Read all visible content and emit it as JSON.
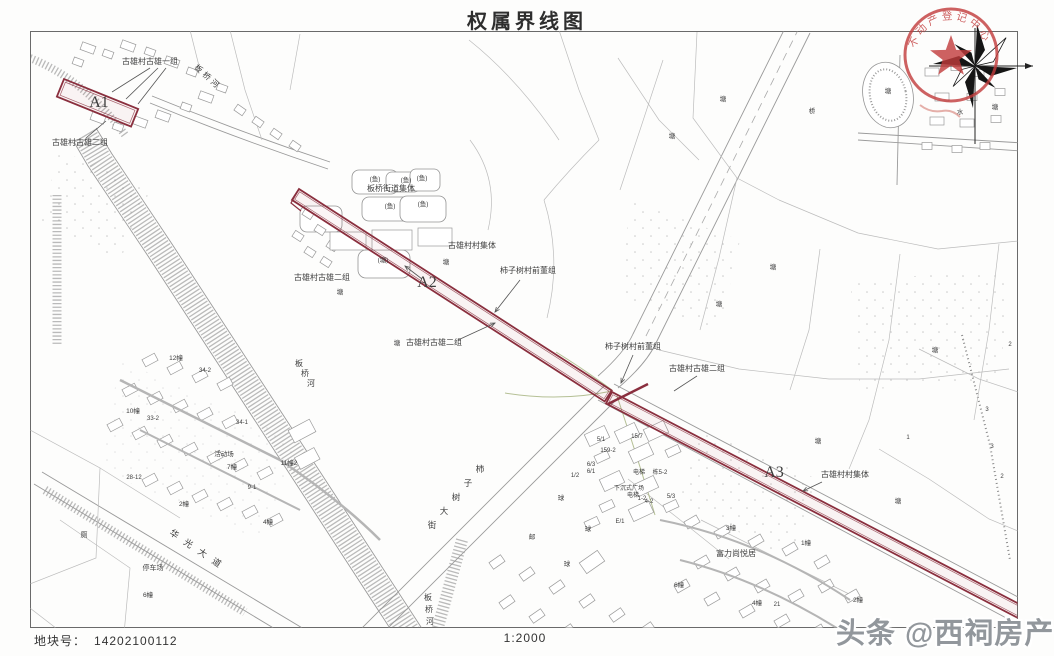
{
  "title": "权属界线图",
  "footer": {
    "plot_label": "地块号：",
    "plot_number": "14202100112",
    "scale": "1:2000"
  },
  "watermark": "头条 @西祠房产",
  "seal": {
    "arc_text": "不动产登记中心",
    "star": "★"
  },
  "parcels": {
    "a1": "A1",
    "a2": "A2",
    "a3": "A3"
  },
  "map_labels": [
    {
      "t": "古雄村古雄一组",
      "x": 150,
      "y": 64,
      "s": 8
    },
    {
      "t": "A1",
      "x": 99,
      "y": 107,
      "s": 16,
      "f": "serif"
    },
    {
      "t": "古雄村古雄二组",
      "x": 80,
      "y": 145,
      "s": 8
    },
    {
      "t": "板桥河",
      "x": 206,
      "y": 79,
      "s": 8,
      "rot": 42,
      "ls": 3
    },
    {
      "t": "板桥街道集体",
      "x": 391,
      "y": 191,
      "s": 8
    },
    {
      "t": "(鱼)",
      "x": 375,
      "y": 181,
      "s": 6.5
    },
    {
      "t": "(鱼)",
      "x": 406,
      "y": 182,
      "s": 6.5
    },
    {
      "t": "(鱼)",
      "x": 422,
      "y": 180,
      "s": 6.5
    },
    {
      "t": "(鱼)",
      "x": 390,
      "y": 208,
      "s": 6.5
    },
    {
      "t": "(鱼)",
      "x": 423,
      "y": 206,
      "s": 6.5
    },
    {
      "t": "(塘)",
      "x": 383,
      "y": 262,
      "s": 6.5
    },
    {
      "t": "塘",
      "x": 446,
      "y": 264,
      "s": 6.5
    },
    {
      "t": "古雄村村集体",
      "x": 472,
      "y": 248,
      "s": 8
    },
    {
      "t": "柿子树村前董组",
      "x": 528,
      "y": 273,
      "s": 8
    },
    {
      "t": "A2",
      "x": 427,
      "y": 287,
      "s": 16,
      "f": "serif"
    },
    {
      "t": "古雄村古雄二组",
      "x": 322,
      "y": 280,
      "s": 8
    },
    {
      "t": "塘",
      "x": 340,
      "y": 294,
      "s": 6.5
    },
    {
      "t": "塘",
      "x": 397,
      "y": 345,
      "s": 6.5
    },
    {
      "t": "古雄村古雄二组",
      "x": 434,
      "y": 345,
      "s": 8
    },
    {
      "t": "柿子树村前董组",
      "x": 633,
      "y": 349,
      "s": 8
    },
    {
      "t": "古雄村古雄二组",
      "x": 697,
      "y": 371,
      "s": 8
    },
    {
      "t": "A3",
      "x": 774,
      "y": 477,
      "s": 16,
      "f": "serif"
    },
    {
      "t": "古雄村村集体",
      "x": 845,
      "y": 477,
      "s": 8
    },
    {
      "t": "富力尚悦居",
      "x": 736,
      "y": 556,
      "s": 8
    },
    {
      "t": "华光大道",
      "x": 197,
      "y": 553,
      "s": 9,
      "rot": 34,
      "ls": 8
    },
    {
      "t": "停车场",
      "x": 153,
      "y": 570,
      "s": 7
    },
    {
      "t": "厕",
      "x": 84,
      "y": 537,
      "s": 7
    },
    {
      "t": "板桥河",
      "x": 428,
      "y": 600,
      "s": 8,
      "vert": true,
      "cdx": 1,
      "cdy": 12
    },
    {
      "t": "板桥河",
      "x": 299,
      "y": 366,
      "s": 8,
      "vert": true,
      "cdx": 6,
      "cdy": 10
    },
    {
      "t": "柿子树大街",
      "x": 480,
      "y": 472,
      "s": 8.5,
      "vert": true,
      "cdx": -12,
      "cdy": 14
    },
    {
      "t": "12幢",
      "x": 176,
      "y": 360,
      "s": 6.5
    },
    {
      "t": "34-2",
      "x": 205,
      "y": 372,
      "s": 6
    },
    {
      "t": "10幢",
      "x": 133,
      "y": 413,
      "s": 6.5
    },
    {
      "t": "33-2",
      "x": 153,
      "y": 420,
      "s": 6
    },
    {
      "t": "34-1",
      "x": 242,
      "y": 424,
      "s": 6
    },
    {
      "t": "活动场",
      "x": 224,
      "y": 456,
      "s": 6.5
    },
    {
      "t": "7幢",
      "x": 232,
      "y": 469,
      "s": 6.5
    },
    {
      "t": "11幢2",
      "x": 289,
      "y": 465,
      "s": 6.5
    },
    {
      "t": "28-12",
      "x": 134,
      "y": 479,
      "s": 6
    },
    {
      "t": "9-1",
      "x": 252,
      "y": 489,
      "s": 6
    },
    {
      "t": "2幢",
      "x": 184,
      "y": 506,
      "s": 6.5
    },
    {
      "t": "4幢",
      "x": 268,
      "y": 524,
      "s": 6.5
    },
    {
      "t": "6幢",
      "x": 148,
      "y": 597,
      "s": 6.5
    },
    {
      "t": "1/2",
      "x": 575,
      "y": 477,
      "s": 6
    },
    {
      "t": "球",
      "x": 561,
      "y": 500,
      "s": 6.5
    },
    {
      "t": "邮",
      "x": 532,
      "y": 539,
      "s": 6.5
    },
    {
      "t": "球",
      "x": 567,
      "y": 566,
      "s": 6.5
    },
    {
      "t": "5/1",
      "x": 601,
      "y": 441,
      "s": 6
    },
    {
      "t": "15/7",
      "x": 637,
      "y": 438,
      "s": 6
    },
    {
      "t": "159-2",
      "x": 608,
      "y": 452,
      "s": 6
    },
    {
      "t": "6/3",
      "x": 591,
      "y": 466,
      "s": 6
    },
    {
      "t": "6/1",
      "x": 591,
      "y": 473,
      "s": 6
    },
    {
      "t": "电梯",
      "x": 639,
      "y": 474,
      "s": 6
    },
    {
      "t": "栋5-2",
      "x": 660,
      "y": 474,
      "s": 6
    },
    {
      "t": "下沉式广场",
      "x": 629,
      "y": 490,
      "s": 6
    },
    {
      "t": "电梯",
      "x": 633,
      "y": 497,
      "s": 6
    },
    {
      "t": "1-2",
      "x": 642,
      "y": 500,
      "s": 6
    },
    {
      "t": "4-2",
      "x": 649,
      "y": 503,
      "s": 6
    },
    {
      "t": "5/3",
      "x": 671,
      "y": 498,
      "s": 6
    },
    {
      "t": "E/1",
      "x": 620,
      "y": 523,
      "s": 6
    },
    {
      "t": "球",
      "x": 588,
      "y": 531,
      "s": 6.5
    },
    {
      "t": "3幢",
      "x": 731,
      "y": 530,
      "s": 6.5
    },
    {
      "t": "1幢",
      "x": 806,
      "y": 545,
      "s": 6.5
    },
    {
      "t": "6幢",
      "x": 679,
      "y": 587,
      "s": 6.5
    },
    {
      "t": "4幢",
      "x": 757,
      "y": 605,
      "s": 6.5
    },
    {
      "t": "21",
      "x": 777,
      "y": 606,
      "s": 6
    },
    {
      "t": "2幢",
      "x": 858,
      "y": 602,
      "s": 6.5
    },
    {
      "t": "塘",
      "x": 723,
      "y": 101,
      "s": 6.5
    },
    {
      "t": "塘",
      "x": 672,
      "y": 138,
      "s": 6.5
    },
    {
      "t": "桥",
      "x": 812,
      "y": 113,
      "s": 6.5
    },
    {
      "t": "塘",
      "x": 888,
      "y": 93,
      "s": 6.5
    },
    {
      "t": "水",
      "x": 960,
      "y": 114,
      "s": 6.5
    },
    {
      "t": "塘",
      "x": 995,
      "y": 109,
      "s": 6.5
    },
    {
      "t": "塘",
      "x": 773,
      "y": 269,
      "s": 6.5
    },
    {
      "t": "塘",
      "x": 719,
      "y": 306,
      "s": 6.5
    },
    {
      "t": "塘",
      "x": 935,
      "y": 352,
      "s": 6.5
    },
    {
      "t": "塘",
      "x": 818,
      "y": 443,
      "s": 6.5
    },
    {
      "t": "塘",
      "x": 898,
      "y": 503,
      "s": 6.5
    },
    {
      "t": "建",
      "x": 1038,
      "y": 509,
      "s": 6.5
    },
    {
      "t": "1",
      "x": 908,
      "y": 439,
      "s": 6
    },
    {
      "t": "3",
      "x": 987,
      "y": 411,
      "s": 6
    },
    {
      "t": "3",
      "x": 992,
      "y": 448,
      "s": 6
    },
    {
      "t": "2",
      "x": 1002,
      "y": 478,
      "s": 6
    },
    {
      "t": "2",
      "x": 1010,
      "y": 346,
      "s": 6
    },
    {
      "t": "2",
      "x": 1032,
      "y": 57,
      "s": 6
    }
  ]
}
